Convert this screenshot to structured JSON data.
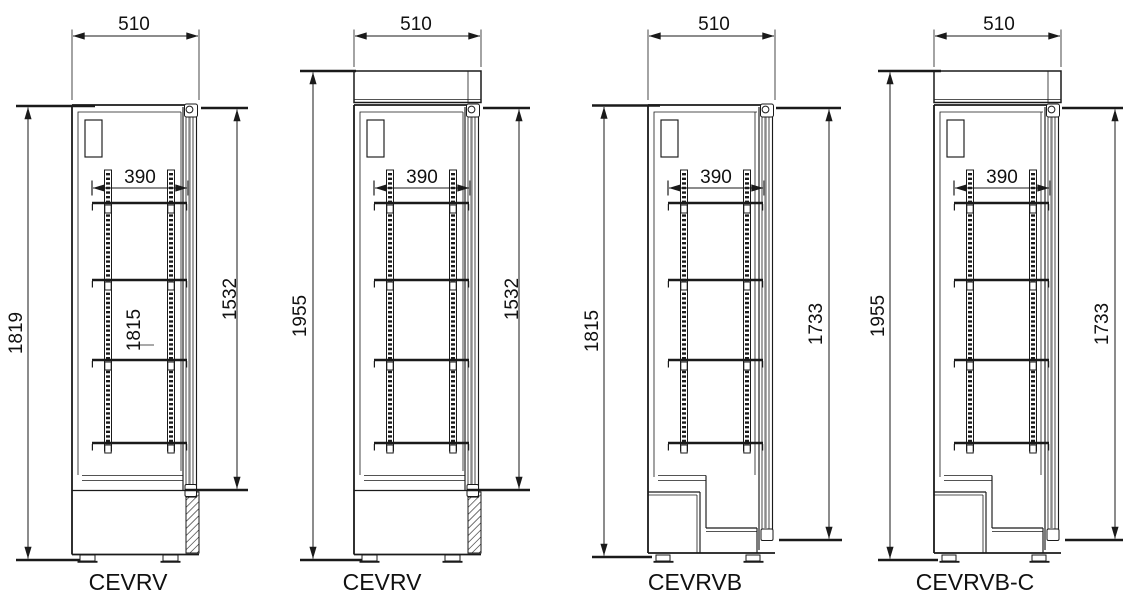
{
  "figures": [
    {
      "id": "cevrv-1",
      "label": "CEVRV",
      "dims": {
        "overall_width": "510",
        "shelf_depth": "390",
        "overall_height": "1819",
        "door_height": "1532",
        "interior_height": "1815"
      }
    },
    {
      "id": "cevrv-2",
      "label": "CEVRV",
      "dims": {
        "overall_width": "510",
        "shelf_depth": "390",
        "overall_height": "1955",
        "door_height": "1532"
      }
    },
    {
      "id": "cevrvb",
      "label": "CEVRVB",
      "dims": {
        "overall_width": "510",
        "shelf_depth": "390",
        "overall_height": "1815",
        "door_height": "1733"
      }
    },
    {
      "id": "cevrvb-c",
      "label": "CEVRVB-C",
      "dims": {
        "overall_width": "510",
        "shelf_depth": "390",
        "overall_height": "1955",
        "door_height": "1733"
      }
    }
  ],
  "colors": {
    "line": "#1a1a1a",
    "background": "#ffffff"
  }
}
